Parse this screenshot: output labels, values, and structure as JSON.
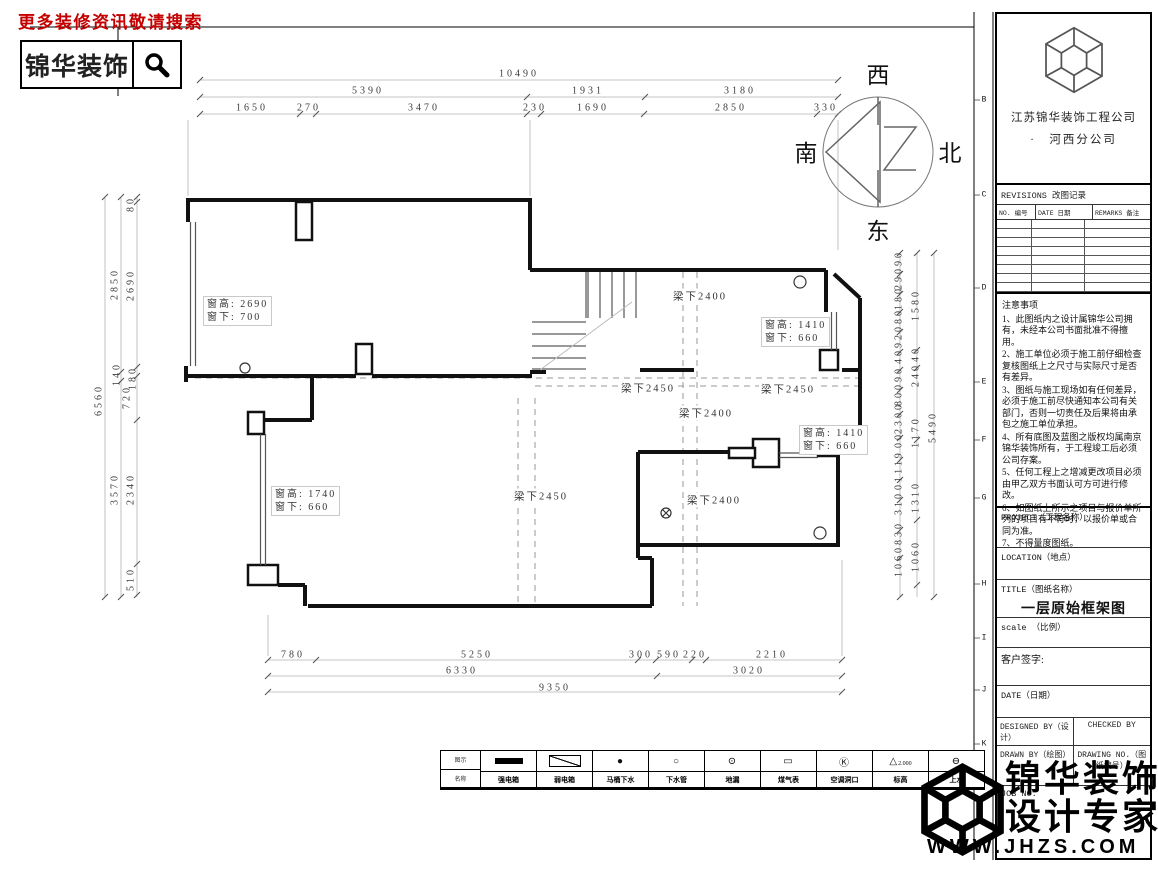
{
  "header": {
    "slogan": "更多装修资讯敬请搜索",
    "logo_text": "锦华装饰"
  },
  "compass": {
    "west": "西",
    "north": "北",
    "east": "东",
    "south": "南"
  },
  "title_block": {
    "company_line1": "江苏锦华装饰工程公司",
    "company_line2": "·　河西分公司",
    "revisions_title": "REVISIONS 改图记录",
    "rev_cols": [
      "NO. 编号",
      "DATE 日期",
      "REMARKS 备注"
    ],
    "revision_rows": [
      "",
      "",
      "",
      "",
      "",
      "",
      "",
      ""
    ],
    "notes_title": "注意事项",
    "notes": [
      "1、此图纸内之设计属锦华公司拥有，未经本公司书面批准不得擅用。",
      "2、施工单位必须于施工前仔细检查复核图纸上之尺寸与实际尺寸是否有差异。",
      "3、图纸与施工现场如有任何差异，必须于施工前尽快通知本公司有关部门，否则一切责任及后果将由承包之施工单位承担。",
      "4、所有底图及蓝图之版权均属南京锦华装饰所有，于工程竣工后必须公司存案。",
      "5、任何工程上之增减更改项目必须由甲乙双方书面认可方可进行修改。",
      "6、如图纸上所示之项目与报价单所列的项目有不符时，以报价单或合同为准。",
      "7、不得量度图纸。"
    ],
    "project_label": "PROJECT（工程名称）",
    "location_label": "LOCATION（地点）",
    "title_label": "TITLE（图纸名称）",
    "drawing_title": "一层原始框架图",
    "scale_label": "scale （比例）",
    "sign_label": "客户签字:",
    "date_label": "DATE（日期）",
    "designed_label": "DESIGNED BY（设计）",
    "checked_label": "CHECKED BY",
    "drawn_label": "DRAWN BY（绘图）",
    "drawing_no_label": "DRAWING NO.（图纸编号）",
    "job_label": "JOB NO."
  },
  "watermark": {
    "line1": "锦华装饰",
    "line2": "设计专家",
    "url": "WWW.JHZS.COM"
  },
  "grid_letters": [
    {
      "t": "B",
      "y": 100
    },
    {
      "t": "C",
      "y": 195
    },
    {
      "t": "D",
      "y": 288
    },
    {
      "t": "E",
      "y": 382
    },
    {
      "t": "F",
      "y": 440
    },
    {
      "t": "G",
      "y": 498
    },
    {
      "t": "H",
      "y": 584
    },
    {
      "t": "I",
      "y": 638
    },
    {
      "t": "J",
      "y": 690
    },
    {
      "t": "K",
      "y": 744
    }
  ],
  "plan": {
    "window_labels": [
      {
        "l1": "窗高: 2690",
        "l2": "窗下: 700",
        "x": 203,
        "y": 296
      },
      {
        "l1": "窗高: 1410",
        "l2": "窗下: 660",
        "x": 761,
        "y": 317
      },
      {
        "l1": "窗高: 1410",
        "l2": "窗下: 660",
        "x": 799,
        "y": 425
      },
      {
        "l1": "窗高: 1740",
        "l2": "窗下: 660",
        "x": 271,
        "y": 486
      }
    ],
    "beam_labels": [
      {
        "t": "梁下2400",
        "x": 700,
        "y": 296
      },
      {
        "t": "梁下2450",
        "x": 648,
        "y": 388
      },
      {
        "t": "梁下2450",
        "x": 788,
        "y": 389
      },
      {
        "t": "梁下2400",
        "x": 706,
        "y": 413
      },
      {
        "t": "梁下2450",
        "x": 541,
        "y": 496
      },
      {
        "t": "梁下2400",
        "x": 714,
        "y": 500
      }
    ],
    "dims_top": [
      {
        "t": "10490",
        "x": 519,
        "y": 74
      },
      {
        "t": "5390",
        "x": 368,
        "y": 91
      },
      {
        "t": "1931",
        "x": 588,
        "y": 91
      },
      {
        "t": "3180",
        "x": 740,
        "y": 91
      },
      {
        "t": "1650",
        "x": 252,
        "y": 108
      },
      {
        "t": "270",
        "x": 309,
        "y": 108
      },
      {
        "t": "3470",
        "x": 424,
        "y": 108
      },
      {
        "t": "230",
        "x": 535,
        "y": 108
      },
      {
        "t": "1690",
        "x": 593,
        "y": 108
      },
      {
        "t": "2850",
        "x": 731,
        "y": 108
      },
      {
        "t": "330",
        "x": 826,
        "y": 108
      }
    ],
    "dims_bottom": [
      {
        "t": "780",
        "x": 293,
        "y": 655
      },
      {
        "t": "5250",
        "x": 477,
        "y": 655
      },
      {
        "t": "300",
        "x": 641,
        "y": 655
      },
      {
        "t": "590",
        "x": 669,
        "y": 655
      },
      {
        "t": "220",
        "x": 695,
        "y": 655
      },
      {
        "t": "2210",
        "x": 772,
        "y": 655
      },
      {
        "t": "6330",
        "x": 462,
        "y": 671
      },
      {
        "t": "3020",
        "x": 749,
        "y": 671
      },
      {
        "t": "9350",
        "x": 555,
        "y": 688
      }
    ],
    "dims_left": [
      {
        "t": "6560",
        "x": 99,
        "y": 400
      },
      {
        "t": "2850",
        "x": 115,
        "y": 284
      },
      {
        "t": "140",
        "x": 117,
        "y": 374
      },
      {
        "t": "3570",
        "x": 115,
        "y": 489
      },
      {
        "t": "80",
        "x": 131,
        "y": 204
      },
      {
        "t": "2690",
        "x": 131,
        "y": 285
      },
      {
        "t": "180",
        "x": 133,
        "y": 378
      },
      {
        "t": "720",
        "x": 127,
        "y": 397
      },
      {
        "t": "2340",
        "x": 131,
        "y": 489
      },
      {
        "t": "510",
        "x": 131,
        "y": 579
      }
    ],
    "dims_right": [
      {
        "t": "5490",
        "x": 933,
        "y": 427
      },
      {
        "t": "1580",
        "x": 916,
        "y": 305
      },
      {
        "t": "40",
        "x": 916,
        "y": 354
      },
      {
        "t": "240",
        "x": 916,
        "y": 375
      },
      {
        "t": "1170",
        "x": 916,
        "y": 432
      },
      {
        "t": "1310",
        "x": 916,
        "y": 497
      },
      {
        "t": "1060",
        "x": 916,
        "y": 556
      },
      {
        "t": "90",
        "x": 899,
        "y": 258
      },
      {
        "t": "290",
        "x": 899,
        "y": 278
      },
      {
        "t": "180",
        "x": 899,
        "y": 298
      },
      {
        "t": "80",
        "x": 899,
        "y": 316
      },
      {
        "t": "920",
        "x": 899,
        "y": 336
      },
      {
        "t": "40",
        "x": 899,
        "y": 356
      },
      {
        "t": "90",
        "x": 899,
        "y": 374
      },
      {
        "t": "800",
        "x": 899,
        "y": 394
      },
      {
        "t": "2300",
        "x": 899,
        "y": 418
      },
      {
        "t": "00",
        "x": 899,
        "y": 440
      },
      {
        "t": "119",
        "x": 899,
        "y": 462
      },
      {
        "t": "01",
        "x": 899,
        "y": 482
      },
      {
        "t": "310",
        "x": 899,
        "y": 503
      },
      {
        "t": "830",
        "x": 899,
        "y": 533
      },
      {
        "t": "1060",
        "x": 899,
        "y": 561
      }
    ]
  },
  "legend": {
    "row1_label": "图示",
    "row2_label": "名称",
    "items": [
      {
        "symbol": "bar",
        "glyph": "",
        "name": "强电箱"
      },
      {
        "symbol": "diag",
        "glyph": "",
        "name": "弱电箱"
      },
      {
        "symbol": "dot",
        "glyph": "●",
        "name": "马桶下水"
      },
      {
        "symbol": "circle",
        "glyph": "○",
        "name": "下水管"
      },
      {
        "symbol": "circledot",
        "glyph": "⊙",
        "name": "地漏"
      },
      {
        "symbol": "meterbox",
        "glyph": "▭",
        "name": "煤气表"
      },
      {
        "symbol": "circlek",
        "glyph": "Ⓚ",
        "name": "空调洞口"
      },
      {
        "symbol": "level",
        "glyph": "△",
        "mark": "2.000",
        "name": "标高"
      },
      {
        "symbol": "waterline",
        "glyph": "⊖",
        "name": "上水"
      }
    ]
  }
}
